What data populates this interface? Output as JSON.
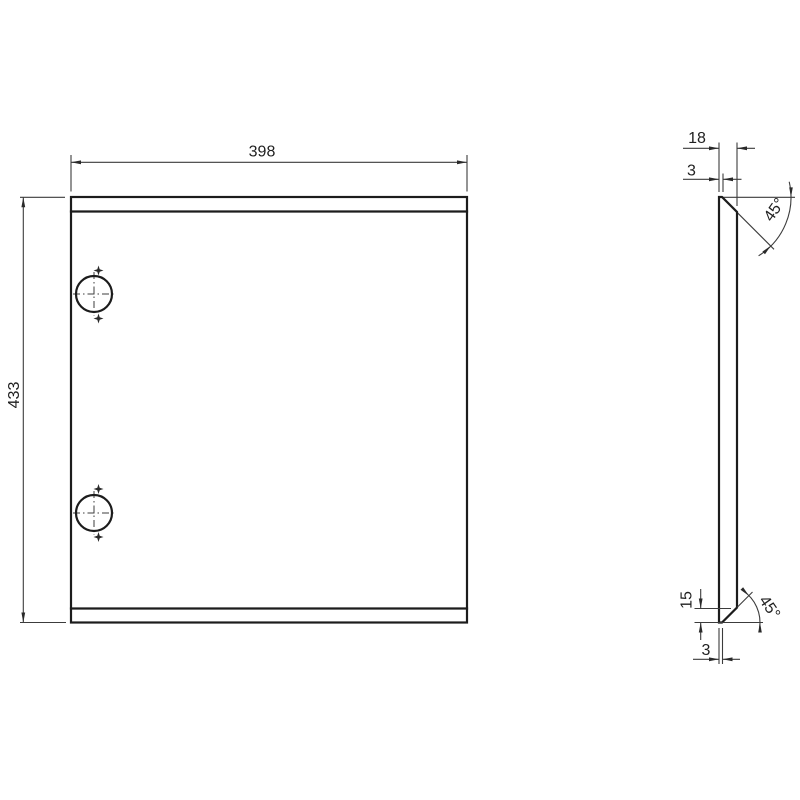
{
  "drawing": {
    "background_color": "#ffffff",
    "object_line_color": "#1c1c1c",
    "dimension_line_color": "#3c3c3c",
    "front_view": {
      "width_dim": "398",
      "height_dim": "433"
    },
    "side_view": {
      "depth_dim": "18",
      "top_thickness_dim": "3",
      "top_chamfer_angle": "45°",
      "bottom_chamfer_height_dim": "15",
      "bottom_thickness_dim": "3",
      "bottom_chamfer_angle": "45°"
    }
  }
}
